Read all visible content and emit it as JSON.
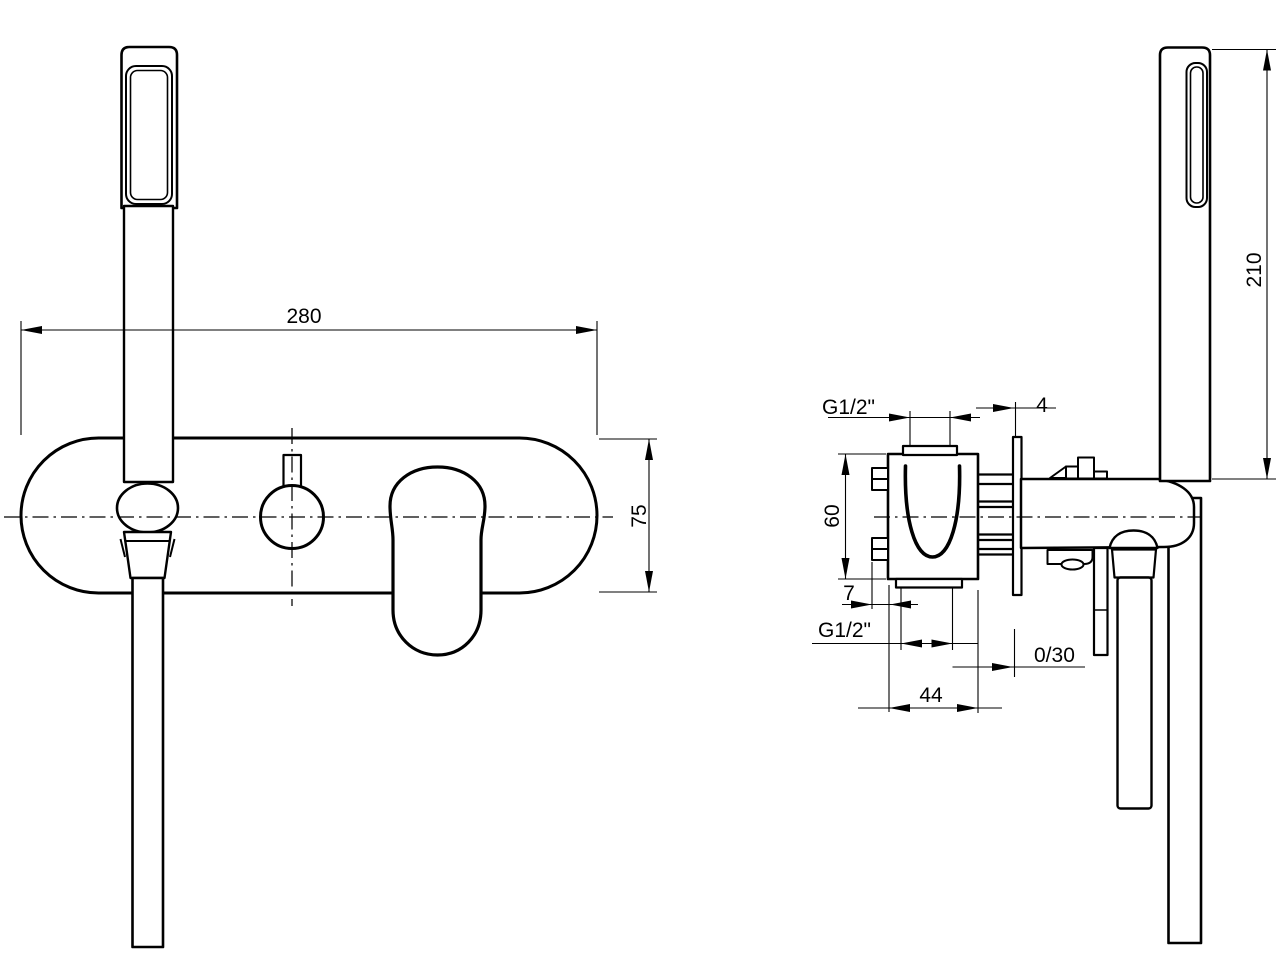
{
  "drawing": {
    "type": "technical-dimension-drawing",
    "subject": "wall-mounted bath shower mixer with hand shower",
    "line_color": "#000000",
    "background_color": "#ffffff",
    "views": {
      "front": {
        "dim_width": "280",
        "dim_height": "75"
      },
      "side": {
        "dim_thread_top": "G1/2\"",
        "dim_plate_thickness": "4",
        "dim_body_height": "60",
        "dim_screw_offset": "7",
        "dim_thread_bottom": "G1/2\"",
        "dim_depth_adjust": "0/30",
        "dim_body_width": "44",
        "dim_handshower_length": "210"
      }
    }
  }
}
